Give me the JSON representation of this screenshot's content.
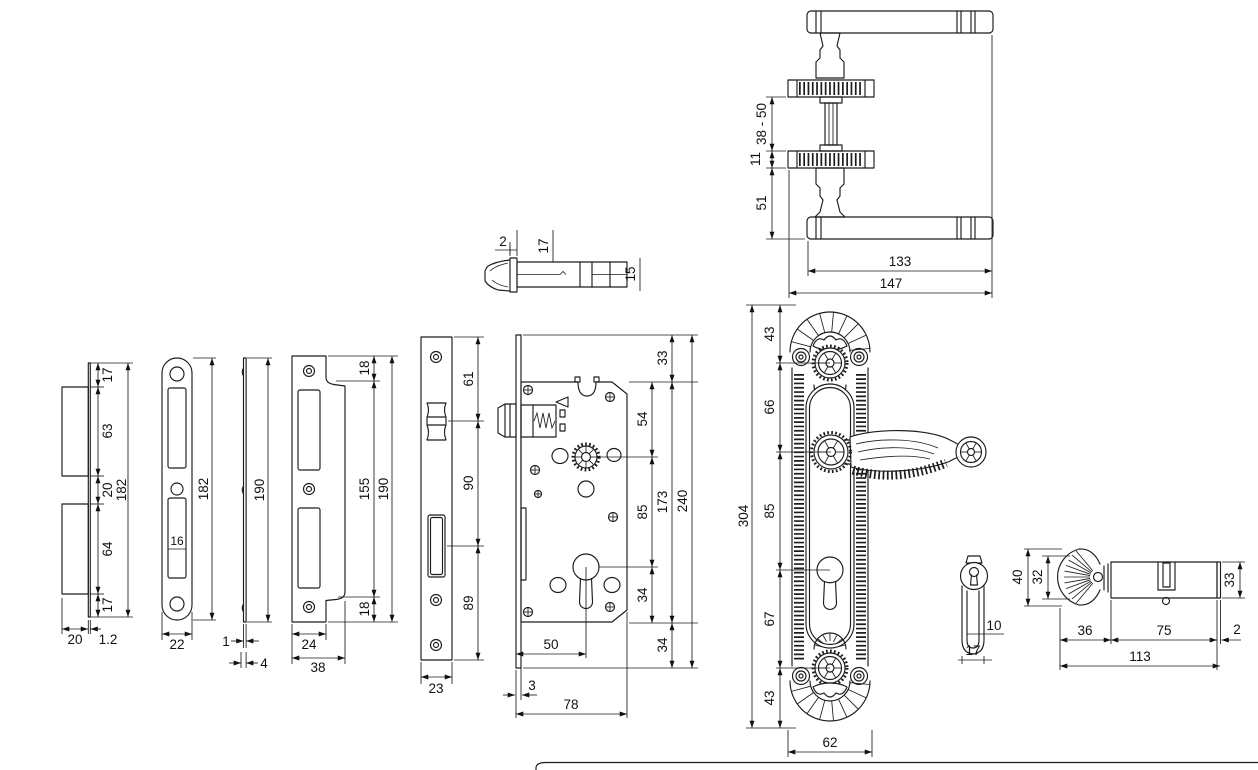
{
  "page": {
    "background": "#ffffff",
    "line_color": "#1c1c1c"
  },
  "views": {
    "strike_box_side": {
      "seg_1": "17",
      "seg_2": "63",
      "seg_3": "20",
      "seg_4": "64",
      "seg_5": "17",
      "total_height": "182",
      "box_depth": "20",
      "plate_thickness": "1.2"
    },
    "strike_plate": {
      "width": "22",
      "slot_width": "16",
      "height": "182"
    },
    "flat_plate_side": {
      "height": "190",
      "thickness": "1",
      "lip_depth": "4"
    },
    "lipped_strike_plate": {
      "top_tab": "18",
      "inner_height": "155",
      "height": "190",
      "bottom_tab": "18",
      "plate_width": "24",
      "total_width": "38"
    },
    "lock_faceplate": {
      "top_to_latch": "61",
      "latch_to_deadbolt": "90",
      "deadbolt_to_bottom": "89",
      "width": "23"
    },
    "lock_body": {
      "top_offset": "33",
      "top_to_spindle": "54",
      "spindle_to_cylinder": "85",
      "cylinder_to_bottom": "34",
      "case_height": "173",
      "faceplate_height": "240",
      "bottom_offset": "34",
      "backset": "50",
      "faceplate_lip": "3",
      "case_depth": "78"
    },
    "latch_bolt_side": {
      "flange_thickness": "2",
      "flange_height": "17",
      "shaft_height": "15"
    },
    "handle_pair": {
      "spindle_range": "38 - 50",
      "rose_thickness": "11",
      "lever_offset": "51",
      "grip_length": "133",
      "overall_length": "147"
    },
    "escutcheon": {
      "top_fan_height": "43",
      "fan_to_handle": "66",
      "handle_to_cylinder": "85",
      "cylinder_to_rose": "67",
      "bottom_fan_height": "43",
      "overall_height": "304",
      "width": "62"
    },
    "escutcheon_side": {
      "inner_width": "10",
      "width": "17"
    },
    "cylinder": {
      "knob_height": "40",
      "knob_inner_height": "32",
      "body_height": "33",
      "knob_length": "36",
      "body_length": "75",
      "cam_ring_thickness": "2",
      "overall_length": "113"
    }
  }
}
